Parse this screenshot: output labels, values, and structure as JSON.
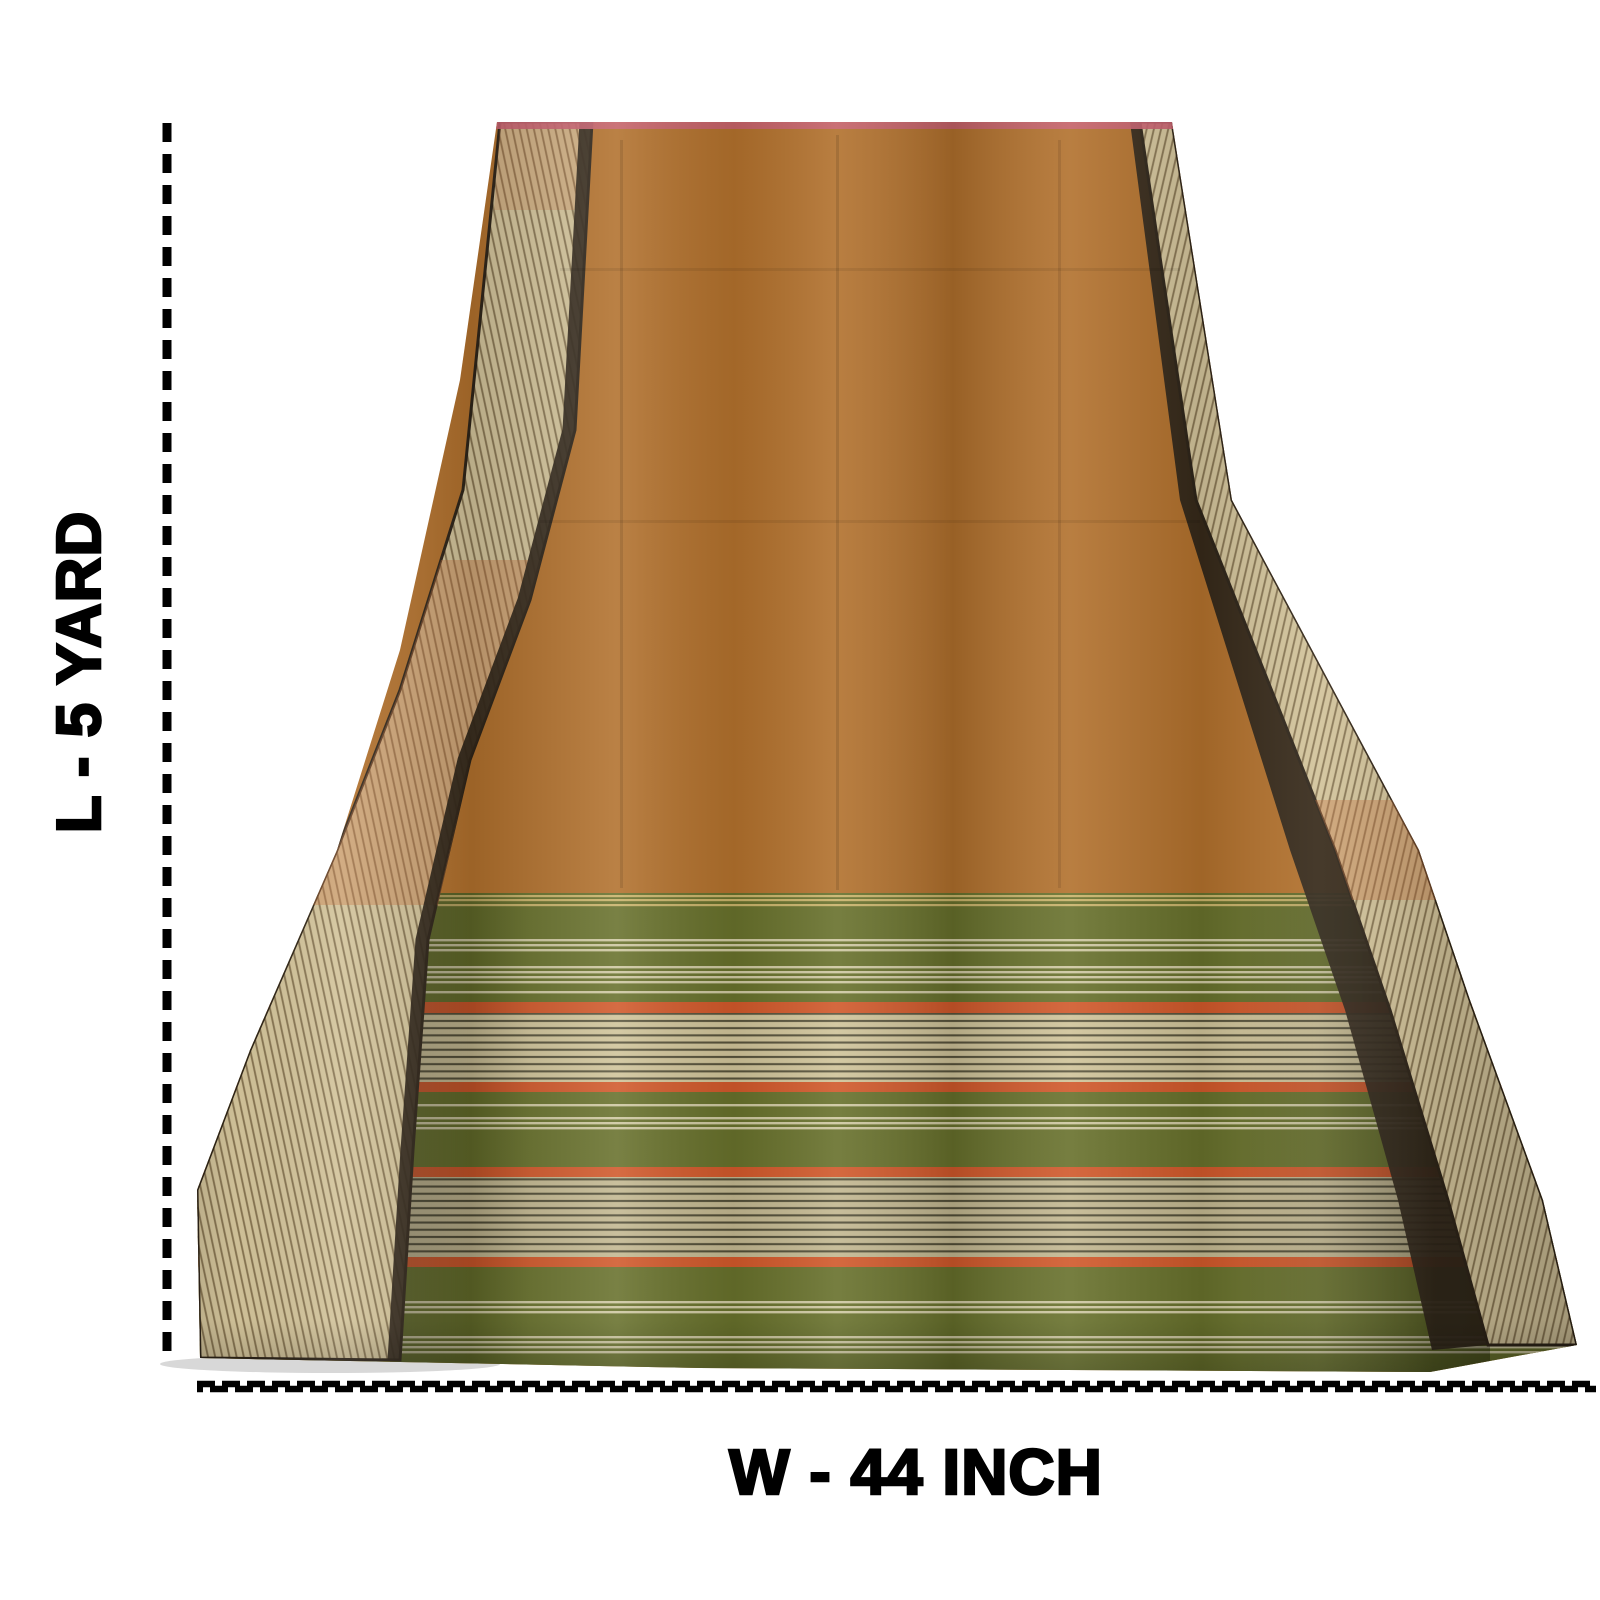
{
  "annotations": {
    "length_label": "L - 5 YARD",
    "width_label": "W - 44 INCH"
  },
  "colors": {
    "background": "#ffffff",
    "text": "#000000",
    "dash": "#000000",
    "body_orange": "#b1702c",
    "border_gold": "#d2c39a",
    "border_stripe": "#7a6845",
    "border_sheen_peach": "#c4713d",
    "edge_dark": "#2e2418",
    "pallu_green": "#67702b",
    "zari_silver": "#cfc399",
    "zari_line": "#57523a",
    "stripe_silver": "#cdc7a0",
    "stripe_gold": "#c8b269",
    "accent_orange": "#d0582a",
    "selvage_pink": "#c65f6e",
    "shadow_gray": "#8e8e8e"
  }
}
